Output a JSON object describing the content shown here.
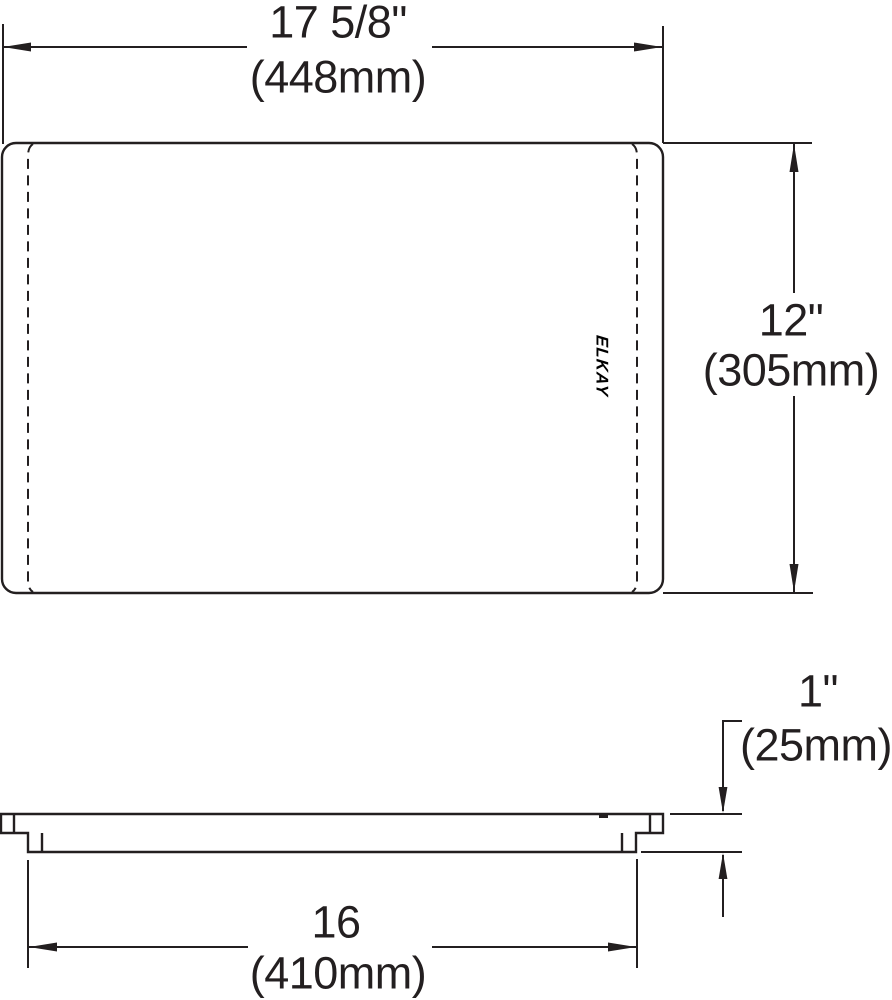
{
  "line_color": "#231f20",
  "brand_logo": "ELKAY",
  "dimensions": {
    "top_width": {
      "in": "17 5/8\"",
      "mm": "(448mm)"
    },
    "side_height": {
      "in": "12\"",
      "mm": "(305mm)"
    },
    "thickness": {
      "in": "1\"",
      "mm": "(25mm)"
    },
    "base_width": {
      "in": "16",
      "mm": "(410mm)"
    }
  }
}
